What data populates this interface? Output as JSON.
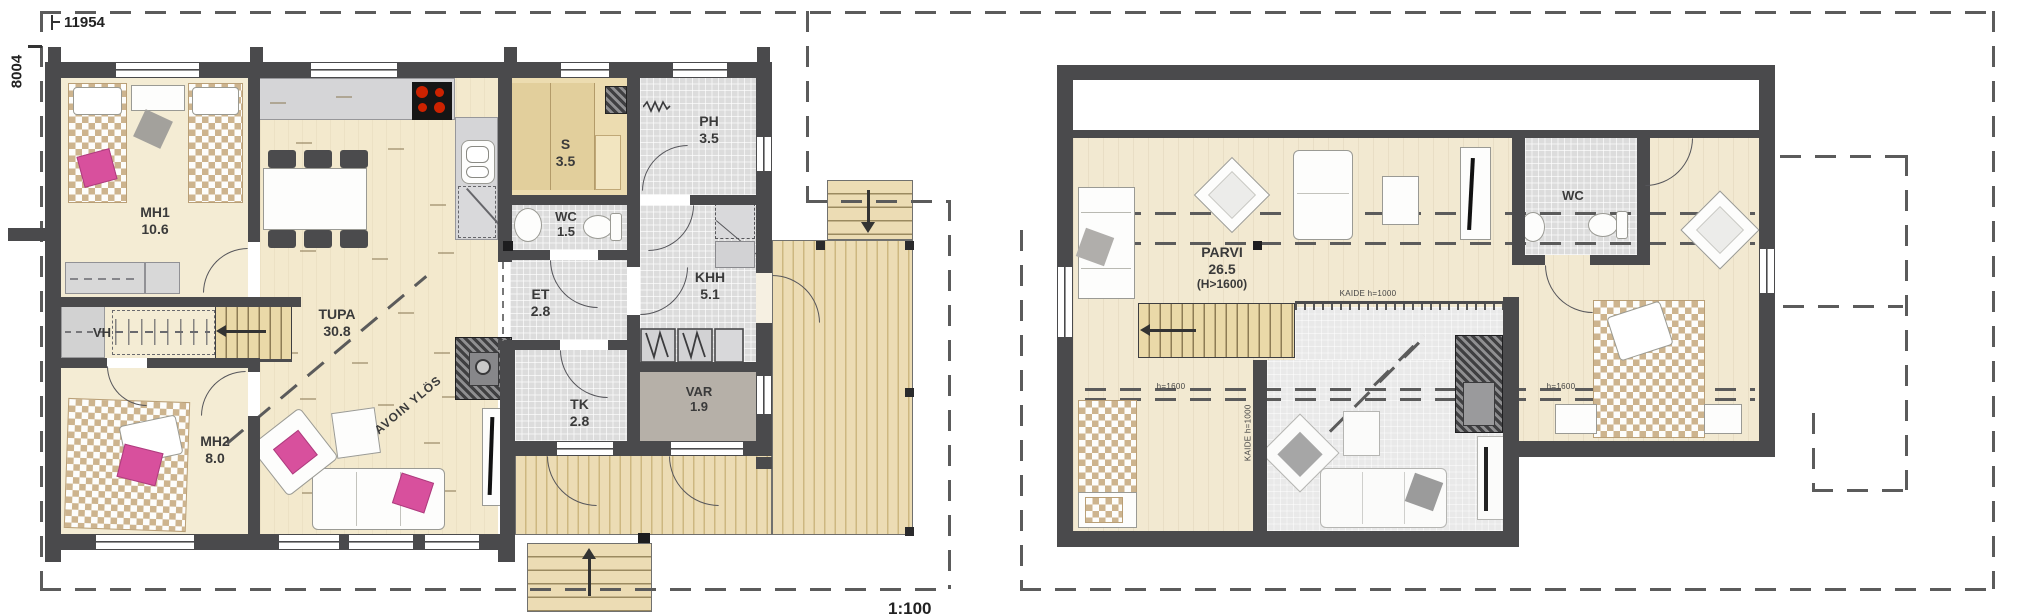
{
  "meta": {
    "scale_label": "1:100",
    "dimension_width_mm": "11954",
    "dimension_height_mm": "8004"
  },
  "ground_floor": {
    "rooms": [
      {
        "name": "MH1",
        "area": "10.6"
      },
      {
        "name": "TUPA",
        "area": "30.8"
      },
      {
        "name": "MH2",
        "area": "8.0"
      },
      {
        "name": "VH",
        "area": ""
      },
      {
        "name": "S",
        "area": "3.5"
      },
      {
        "name": "PH",
        "area": "3.5"
      },
      {
        "name": "WC",
        "area": "1.5"
      },
      {
        "name": "ET",
        "area": "2.8"
      },
      {
        "name": "KHH",
        "area": "5.1"
      },
      {
        "name": "TK",
        "area": "2.8"
      },
      {
        "name": "VAR",
        "area": "1.9"
      }
    ],
    "annotations": {
      "open_above": "AVOIN YLÖS"
    }
  },
  "upper_floor": {
    "rooms": [
      {
        "name": "PARVI",
        "area": "26.5",
        "note": "(H>1600)"
      },
      {
        "name": "WC",
        "area": ""
      }
    ],
    "annotations": {
      "railing": "KAIDE h=1000",
      "railing_vertical": "KAIDE h=1000",
      "height_left": "h=1600",
      "height_right": "h=1600"
    }
  },
  "colors": {
    "wall": "#4a4a4c",
    "floor_beige": "#f4ecd4",
    "floor_tile": "#dcdcdc",
    "wood_deck": "#ecdcb4",
    "accent_pink": "#d8509d",
    "stove_burner": "#cc2200",
    "storage_floor": "#b6b0a8",
    "void_gray": "#e9e9e9"
  }
}
